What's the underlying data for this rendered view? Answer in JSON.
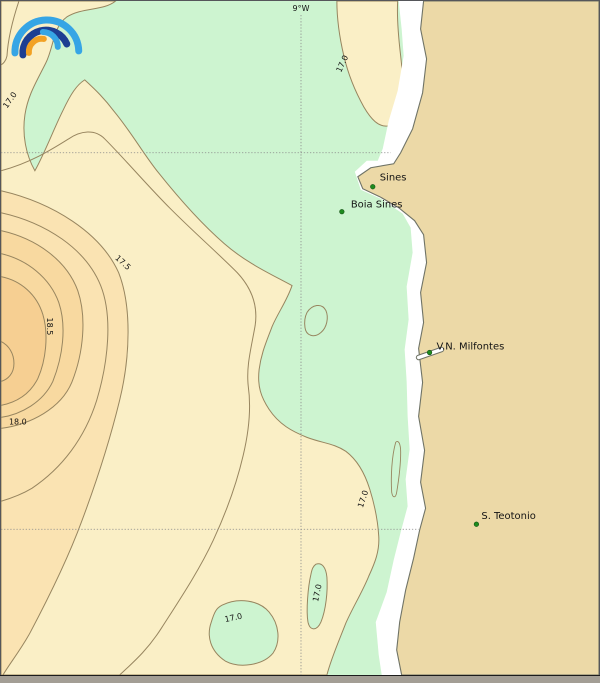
{
  "map": {
    "meridian_label": "9°W",
    "stations": [
      {
        "name": "Sines"
      },
      {
        "name": "Boia Sines"
      },
      {
        "name": "V.N. Milfontes"
      },
      {
        "name": "S. Teotonio"
      }
    ],
    "contour_labels": {
      "c170": "17.0",
      "c175": "17.5",
      "c180": "18.0",
      "c185": "18.5"
    },
    "isotherms_shown": [
      "17.0",
      "17.5",
      "18.0",
      "18.5"
    ]
  },
  "palette": {
    "sea_green": "#cdf4d0",
    "band_17": "#faefc6",
    "band_175": "#fae3b2",
    "band_18": "#f8d9a0",
    "band_185": "#f6cf92",
    "land": "#ecd9a7",
    "white_band": "#ffffff",
    "contour_line": "#97855f",
    "coastline": "#6f7366",
    "graticule": "#8a8a8a",
    "station_green": "#1e8b1e",
    "station_edge": "#145214",
    "logo_blue": "#36a5e5",
    "logo_navy": "#1d3e92",
    "logo_orange": "#f2a124",
    "frame_gray": "#55565a",
    "bottom_bar": "#a39e95"
  }
}
